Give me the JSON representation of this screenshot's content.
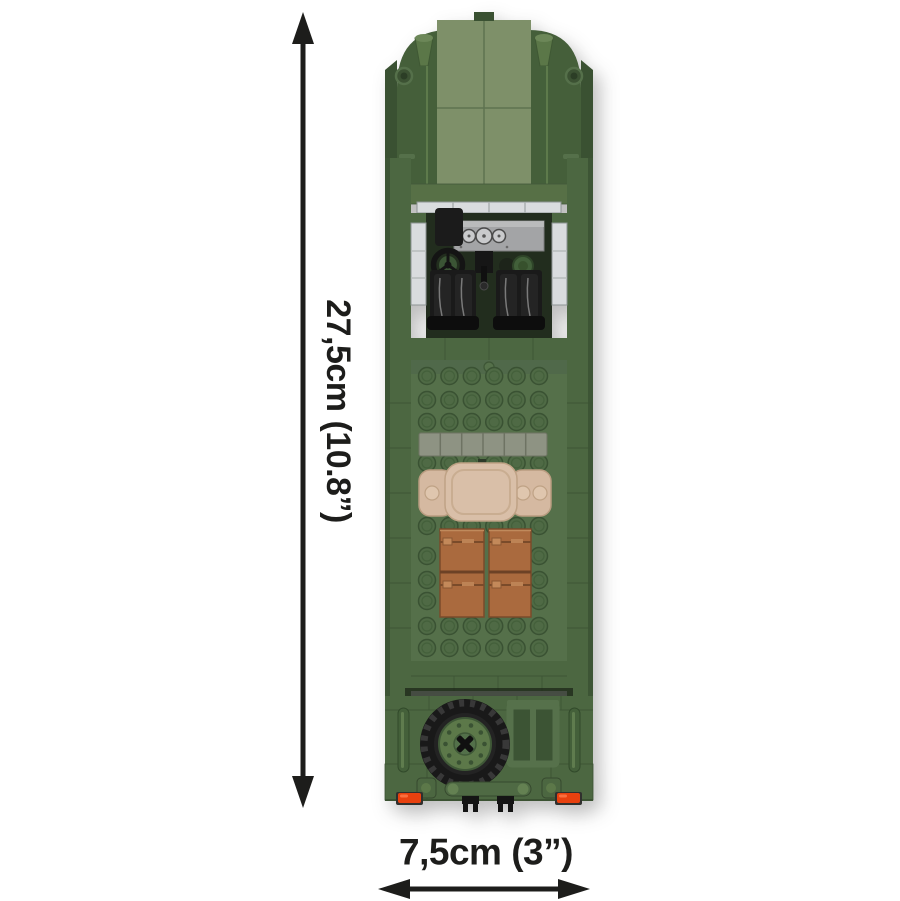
{
  "dimensions": {
    "height_label": "27,5cm (10.8”)",
    "width_label": "7,5cm (3”)"
  },
  "icons": {
    "height_arrow": "double-headed-vertical-arrow",
    "width_arrow": "double-headed-horizontal-arrow"
  },
  "colors": {
    "background": "#ffffff",
    "dimension": "#1d1d1b",
    "body_green": "#4c6741",
    "dark_green": "#3a5132",
    "hood_green": "#7e9069",
    "plate_green": "#55704a",
    "stud_green": "#4f6a45",
    "cowl_green": "#577046",
    "tile_gray": "#8e9383",
    "glass_gray": "#d9dcde",
    "dash_gray": "#a3a4a6",
    "seat_black": "#1a1a1a",
    "interior_black": "#222d1e",
    "bedroll_tan": "#d9bfa8",
    "crate_brown": "#aa6a3e",
    "tire_black": "#191919",
    "hub_green": "#5c7849",
    "taillight_red": "#e8410f"
  }
}
